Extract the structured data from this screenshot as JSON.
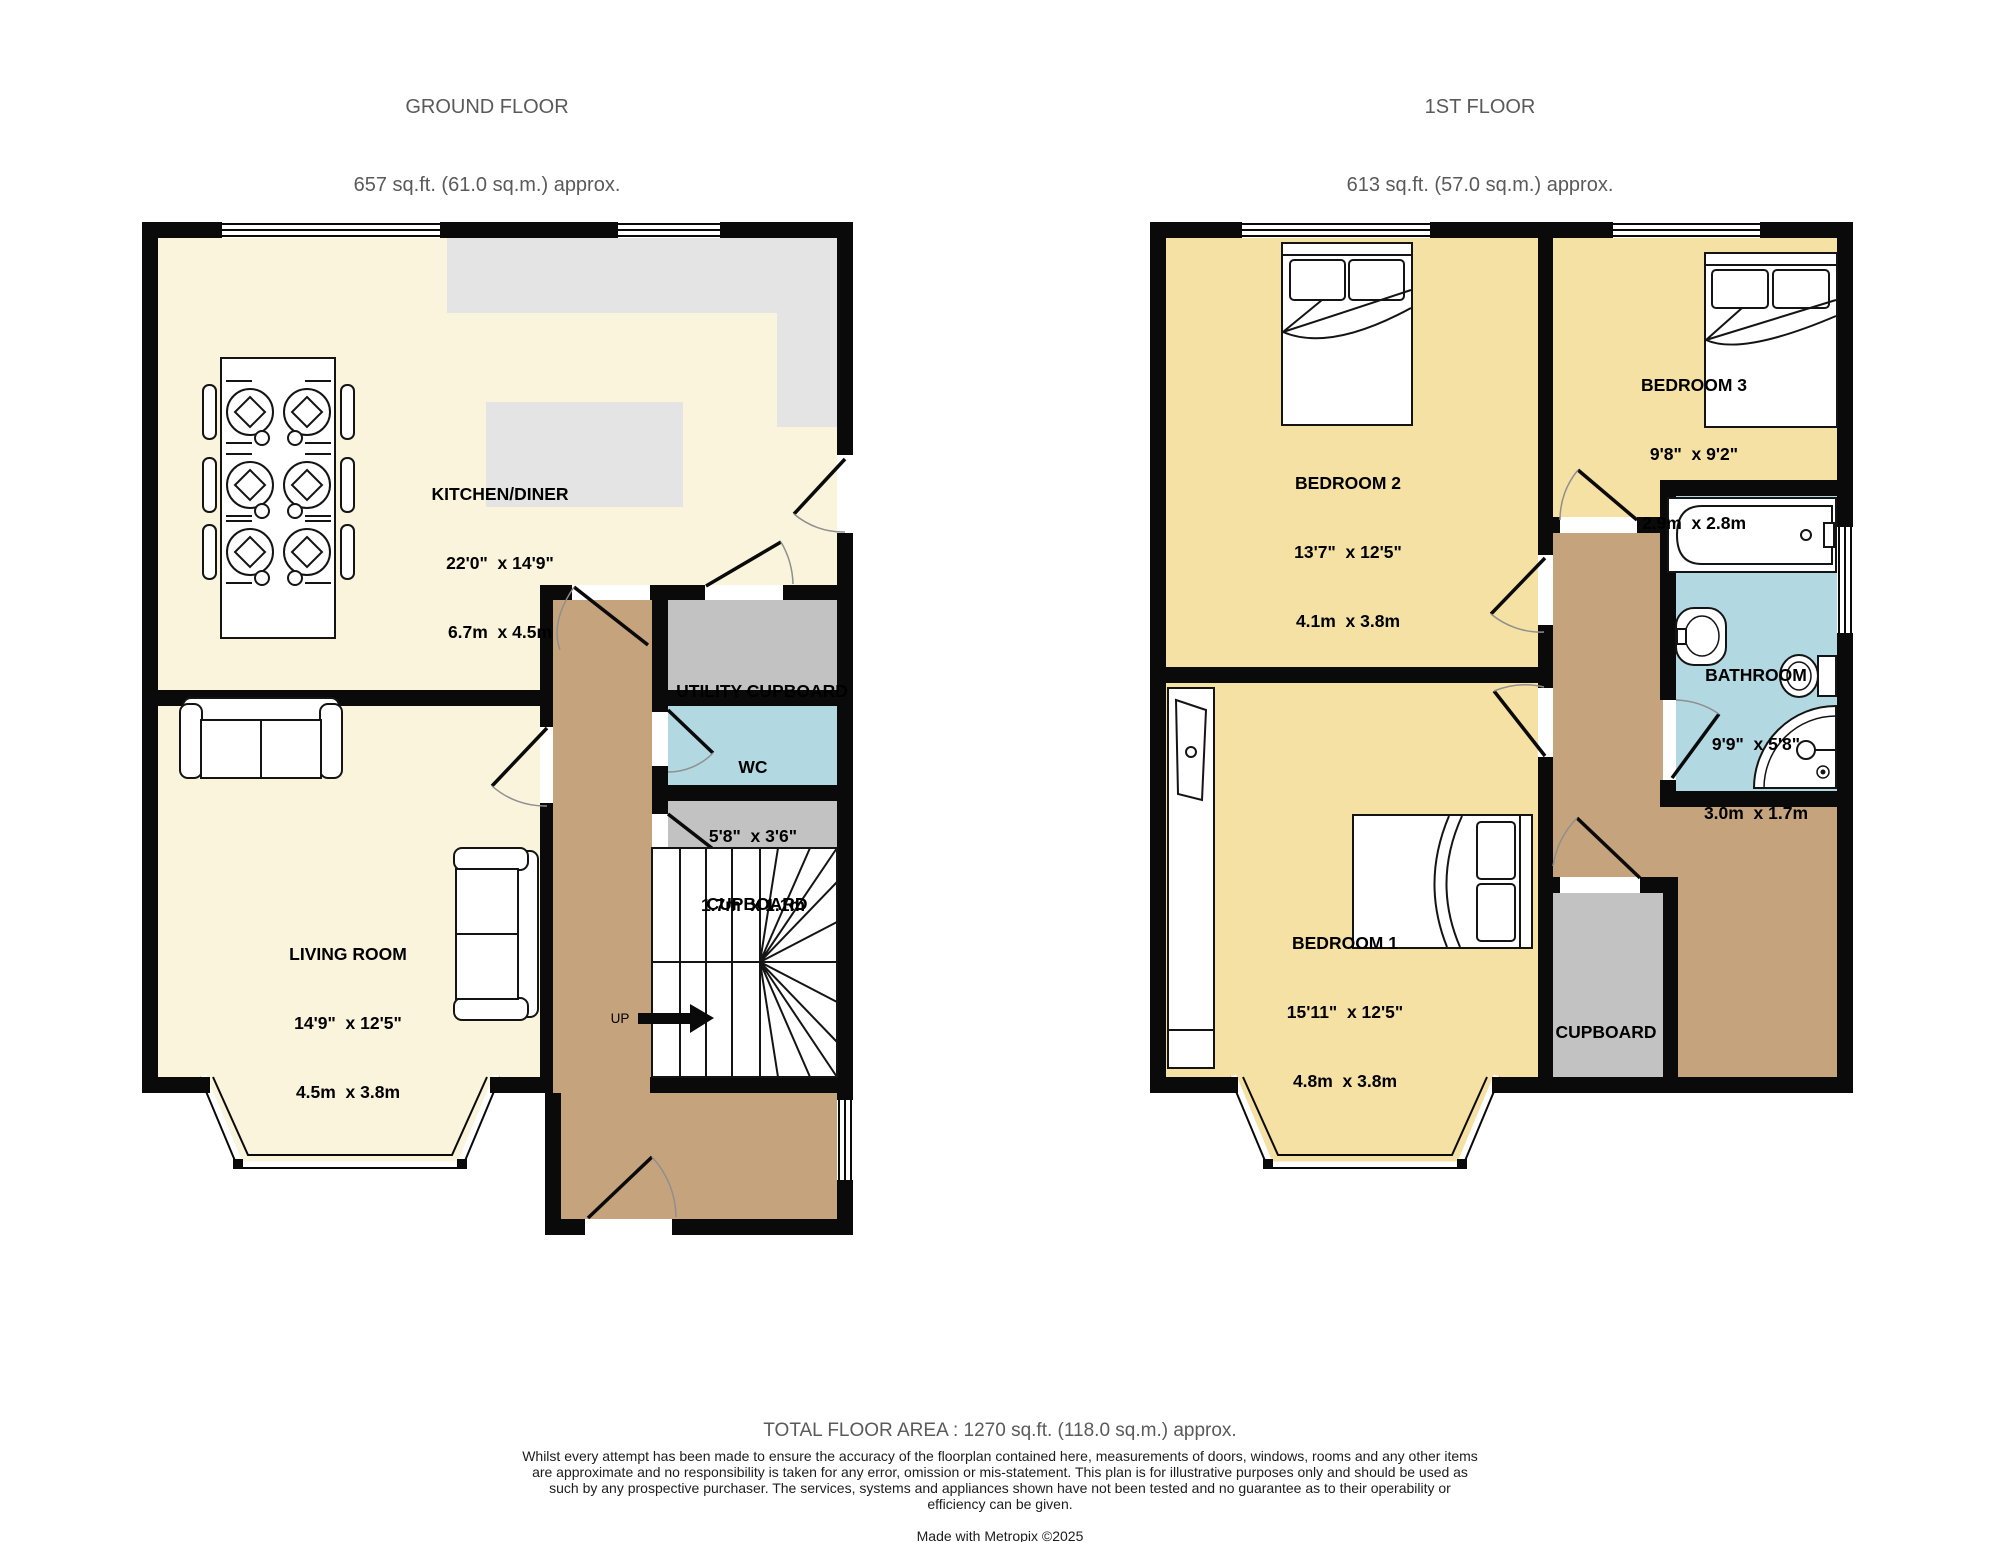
{
  "ground_floor": {
    "header": {
      "title": "GROUND FLOOR",
      "area": "657 sq.ft. (61.0 sq.m.) approx."
    },
    "rooms": {
      "kitchen_diner": {
        "name": "KITCHEN/DINER",
        "imperial": "22'0\"  x 14'9\"",
        "metric": "6.7m  x 4.5m"
      },
      "living_room": {
        "name": "LIVING ROOM",
        "imperial": "14'9\"  x 12'5\"",
        "metric": "4.5m  x 3.8m"
      },
      "wc": {
        "name": "WC",
        "imperial": "5'8\"  x 3'6\"",
        "metric": "1.7m  x 1.1m"
      },
      "utility_cupboard": {
        "name": "UTILITY CUPBOARD"
      },
      "cupboard": {
        "name": "CUPBOARD"
      }
    },
    "stairs": {
      "direction_label": "UP"
    }
  },
  "first_floor": {
    "header": {
      "title": "1ST FLOOR",
      "area": "613 sq.ft. (57.0 sq.m.) approx."
    },
    "rooms": {
      "bedroom_1": {
        "name": "BEDROOM 1",
        "imperial": "15'11\"  x 12'5\"",
        "metric": "4.8m  x 3.8m"
      },
      "bedroom_2": {
        "name": "BEDROOM 2",
        "imperial": "13'7\"  x 12'5\"",
        "metric": "4.1m  x 3.8m"
      },
      "bedroom_3": {
        "name": "BEDROOM 3",
        "imperial": "9'8\"  x 9'2\"",
        "metric": "2.9m  x 2.8m"
      },
      "bathroom": {
        "name": "BATHROOM",
        "imperial": "9'9\"  x 5'8\"",
        "metric": "3.0m  x 1.7m"
      },
      "cupboard": {
        "name": "CUPBOARD"
      }
    }
  },
  "footer": {
    "total_area": "TOTAL FLOOR AREA : 1270 sq.ft. (118.0 sq.m.) approx.",
    "disclaimer": "Whilst every attempt has been made to ensure the accuracy of the floorplan contained here, measurements of doors, windows, rooms and any other items are approximate and no responsibility is taken for any error, omission or mis-statement. This plan is for illustrative purposes only and should be used as such by any prospective purchaser. The services, systems and appliances shown have not been tested and no guarantee as to their operability or efficiency can be given.",
    "credit": "Made with Metropix ©2025"
  },
  "colors": {
    "wall": "#0a0a0a",
    "ground_floor_room": "#faf4dc",
    "bedroom": "#f5e1a3",
    "wet_room_blue": "#b2d8e2",
    "hallway_brown": "#c5a37d",
    "cupboard_grey": "#c2c2c2",
    "counter_grey": "#e4e4e4",
    "heading_text": "#5a5a5a",
    "label_text": "#000000"
  }
}
